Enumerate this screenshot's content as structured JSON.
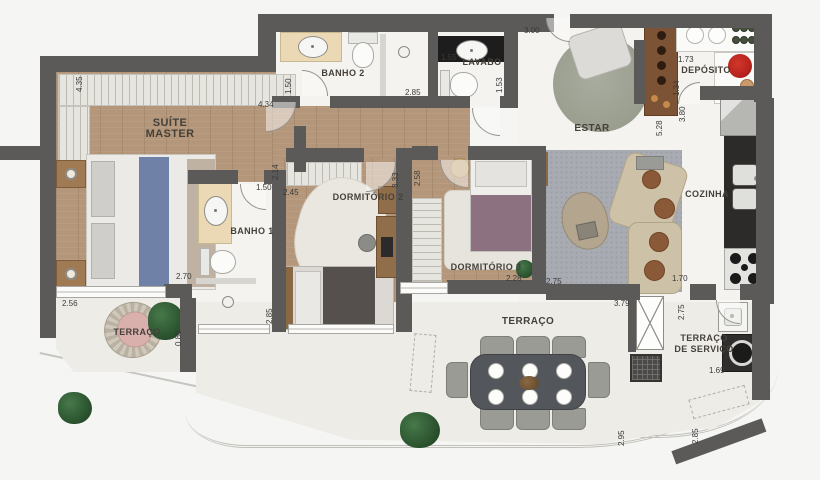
{
  "rooms": {
    "suite_master": {
      "line1": "SUÍTE",
      "line2": "MASTER"
    },
    "banho2": {
      "label": "BANHO 2"
    },
    "lavabo": {
      "label": "LAVABO"
    },
    "estar": {
      "label": "ESTAR"
    },
    "deposito": {
      "label": "DEPÓSITO"
    },
    "cozinha": {
      "label": "COZINHA"
    },
    "banho1": {
      "label": "BANHO 1"
    },
    "dormitorio2": {
      "label": "DORMITÓRIO 2"
    },
    "dormitorio3": {
      "label": "DORMITÓRIO 3"
    },
    "terraco_left": {
      "label": "TERRAÇO"
    },
    "terraco_main": {
      "label": "TERRAÇO"
    },
    "terraco_servico": {
      "line1": "TERRAÇO",
      "line2": "DE SERVIÇO"
    }
  },
  "measurements": {
    "suite_left_v": "4.35",
    "suite_top": "4.34",
    "suite_door_v": "2.14",
    "banho2_left_v": "1.50",
    "banho2_width": "2.85",
    "lavabo_width": "1.55",
    "lavabo_depth_v": "1.53",
    "estar_top": "3.00",
    "deposito_width": "1.73",
    "deposito_depth_v": "1.34",
    "cozinha_len_v": "3.80",
    "estar_len_v": "5.28",
    "banho1_top": "1.50",
    "dorm2_top": "2.45",
    "suite_bottom": "2.70",
    "terraco1_top": "2.56",
    "terraco1_right_v": "0.80",
    "banho1_bottom_v": "2.85",
    "hall_dorm2_v": "3.33",
    "hall_dorm3_v": "2.58",
    "dorm3_bottom": "2.28",
    "rug_bottom": "2.75",
    "cozinha_bottom": "1.70",
    "terraco_top": "3.79",
    "servico_left_v": "2.75",
    "terraco_right_v": "2.95",
    "servico_width": "1.69",
    "servico_right_v": "2.85"
  },
  "colors": {
    "wall": "#5b5a58",
    "wood_floor": "#b4977a",
    "wet_floor": "#f4f3ef",
    "terrace_floor": "#edece7",
    "rug": "#a8abb1",
    "blue_blanket": "#6f81a6",
    "purple_blanket": "#8c7181",
    "red_pot": "#b9241e",
    "dark_counter": "#1d1d1d"
  }
}
